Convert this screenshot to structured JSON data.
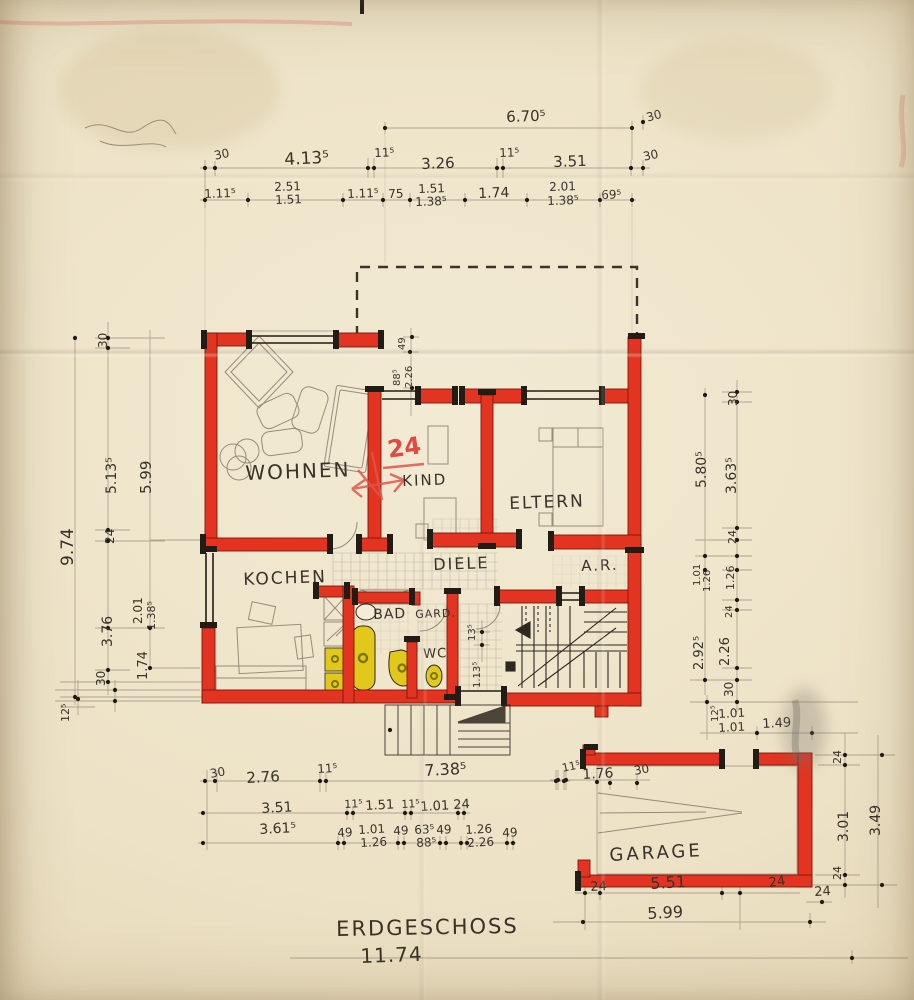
{
  "title": {
    "name": "ERDGESCHOSS",
    "overall_width": "11.74"
  },
  "rooms": {
    "wohnen": "WOHNEN",
    "kind": "KIND",
    "eltern": "ELTERN",
    "diele": "DIELE",
    "ar": "A.R.",
    "kochen": "KOCHEN",
    "bad": "BAD",
    "gard": "GARD.",
    "wc": "WC",
    "garage": "GARAGE"
  },
  "annotation_red": {
    "value": "24"
  },
  "colors": {
    "wall_red": "#e23420",
    "wall_edge": "#7c170c",
    "cap_black": "#211c15",
    "fixture_yellow": "#e2c81a",
    "fixture_ring": "#7a7410",
    "ink": "#2d2820",
    "pencil": "#7c7263",
    "red_pencil": "#e0544a",
    "paper": "#ede2c6"
  },
  "dims": {
    "top": {
      "overall": "6.70⁵",
      "overall_right": "30",
      "row2": [
        "30",
        "4.13⁵",
        "11⁵",
        "3.26",
        "11⁵",
        "3.51",
        "30"
      ],
      "row3": [
        "1.11⁵",
        "2.51",
        "1.51",
        "1.11⁵",
        "75",
        "1.51",
        "1.38⁵",
        "1.74",
        "2.01",
        "1.38⁵",
        "69⁵"
      ]
    },
    "left": {
      "col1": [
        "9.74"
      ],
      "col2": [
        "30",
        "5.13⁵",
        "24",
        "3.76",
        "30",
        "12⁵"
      ],
      "col3": [
        "5.99",
        "2.01",
        "1.38⁵",
        "1.74"
      ]
    },
    "right": {
      "col_inner": [
        "5.80⁵",
        "1.01",
        "1.26",
        "2.92⁵"
      ],
      "col_outer": [
        "30",
        "3.63⁵",
        "24",
        "1.26",
        "24",
        "2.26",
        "30"
      ]
    },
    "inner": {
      "top_chain": [
        "49",
        "88⁵",
        "2.26"
      ],
      "stair_chain": [
        "13⁵",
        "1.13⁵"
      ]
    },
    "bottom": {
      "row1": [
        "30",
        "2.76",
        "11⁵",
        "7.38⁵"
      ],
      "row2": [
        "3.51",
        "11⁵",
        "1.51",
        "11⁵",
        "1.01",
        "24"
      ],
      "row3": [
        "3.61⁵",
        "49",
        "1.01",
        "1.26",
        "49",
        "63⁵",
        "88⁵",
        "49",
        "1.26",
        "2.26",
        "49"
      ]
    },
    "garage": {
      "top": [
        "11⁵",
        "1.76",
        "30"
      ],
      "above": [
        "12⁵",
        "1.01",
        "1.01",
        "1.49"
      ],
      "right": [
        "24",
        "3.01",
        "3.49",
        "24",
        "24"
      ],
      "bottom": [
        "24",
        "5.51",
        "24",
        "5.99"
      ]
    }
  }
}
